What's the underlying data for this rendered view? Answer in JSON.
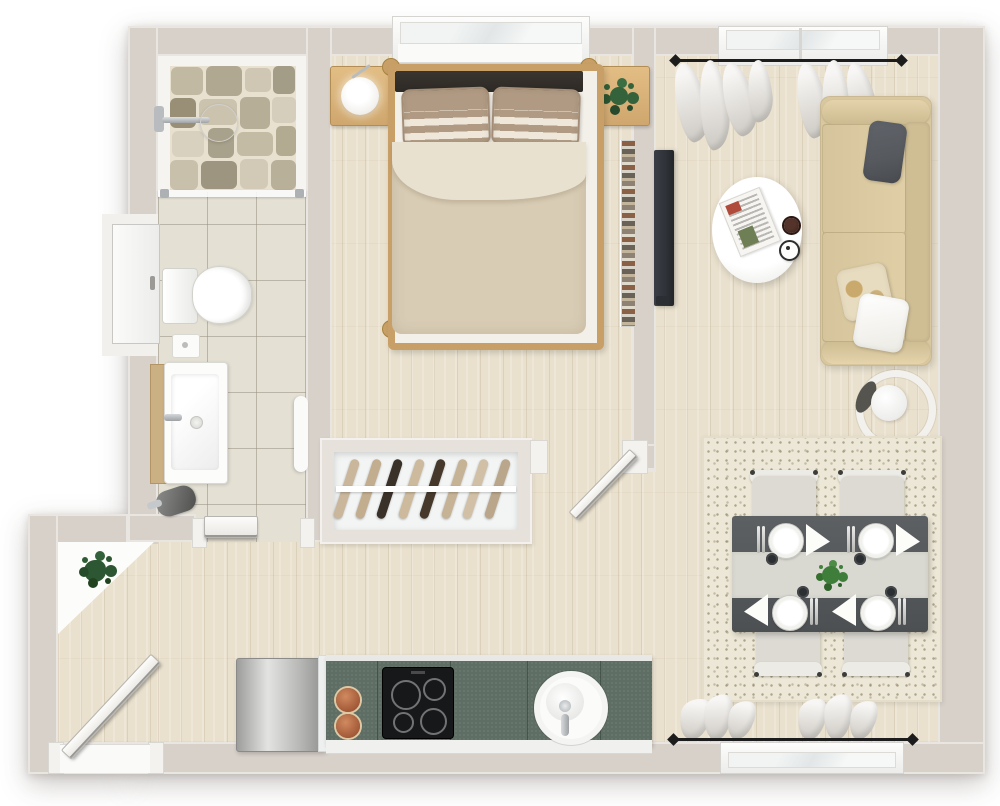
{
  "meta": {
    "title": "Studio apartment 3D floor plan (top-down render)",
    "view": "bird's-eye",
    "canvas": {
      "width": 1000,
      "height": 806
    }
  },
  "palette": {
    "wall": "#d8d1ca",
    "wood": "#e9e0cd",
    "tile": "#e4e0d4",
    "counter": "#5e6e64",
    "cooktop": "#17181a",
    "copper": "#b9714e",
    "steel": "#c6c6c5",
    "sofa": "#d9c89f",
    "rug": "#ece7d6",
    "table": "#54585b",
    "runner": "#d9d8d1",
    "chair": "#dcdad3",
    "chairback": "#edebe6",
    "bedframe": "#c8a067",
    "headboard": "#2d2925",
    "mattress": "#f3f0e9",
    "duvet": "#d8ccb5",
    "fold": "#e9e1d0",
    "woodfurn": "#d9b277",
    "plantdark": "#2d5732",
    "plantmid": "#34623a",
    "plantbright": "#3f7d3b",
    "tv": "#2f3338",
    "chrome": "#b9bcbe",
    "whiteobj": "#fbfbf9",
    "pillowgray": "#56595e"
  },
  "rooms": [
    {
      "id": "bathroom",
      "label": "Bathroom",
      "features": [
        "walk-in stone shower with glass partition",
        "wall shower head",
        "toilet",
        "vanity sink",
        "tiled floor"
      ]
    },
    {
      "id": "bedroom",
      "label": "Bedroom",
      "features": [
        "double bed with wood frame",
        "2 striped pillows",
        "nightstand with lamp",
        "nightstand with plant",
        "bookshelf",
        "window",
        "open wardrobe"
      ]
    },
    {
      "id": "living-room",
      "label": "Living room",
      "features": [
        "beige sofa with 3 cushions",
        "oval coffee table with newspaper, coffee cup and clock coaster",
        "wall-mounted TV",
        "ring floor lamp",
        "curtained windows"
      ]
    },
    {
      "id": "dining-area",
      "label": "Dining area",
      "features": [
        "dark dining table with runner",
        "4 chairs",
        "4 place settings",
        "green centerpiece",
        "patterned rug"
      ]
    },
    {
      "id": "kitchen",
      "label": "Kitchen",
      "features": [
        "stainless fridge",
        "green countertop",
        "4-burner cooktop",
        "round sink",
        "2 copper pans"
      ]
    },
    {
      "id": "hallway",
      "label": "Hallway / entrance",
      "features": [
        "entrance door ajar",
        "corner shelf with plant"
      ]
    }
  ],
  "wardrobe": {
    "hanger_count": 8,
    "hanger_colors": [
      "#c9b69b",
      "#c2ad8f",
      "#3a3129",
      "#cdb99c",
      "#46392c",
      "#c6b295",
      "#d1c0a5",
      "#baa68a"
    ]
  },
  "counts": {
    "windows": 4,
    "doors": 4,
    "dining_chairs": 4,
    "place_settings": 4,
    "cooktop_burners": 4,
    "sofa_pillows": 3
  }
}
